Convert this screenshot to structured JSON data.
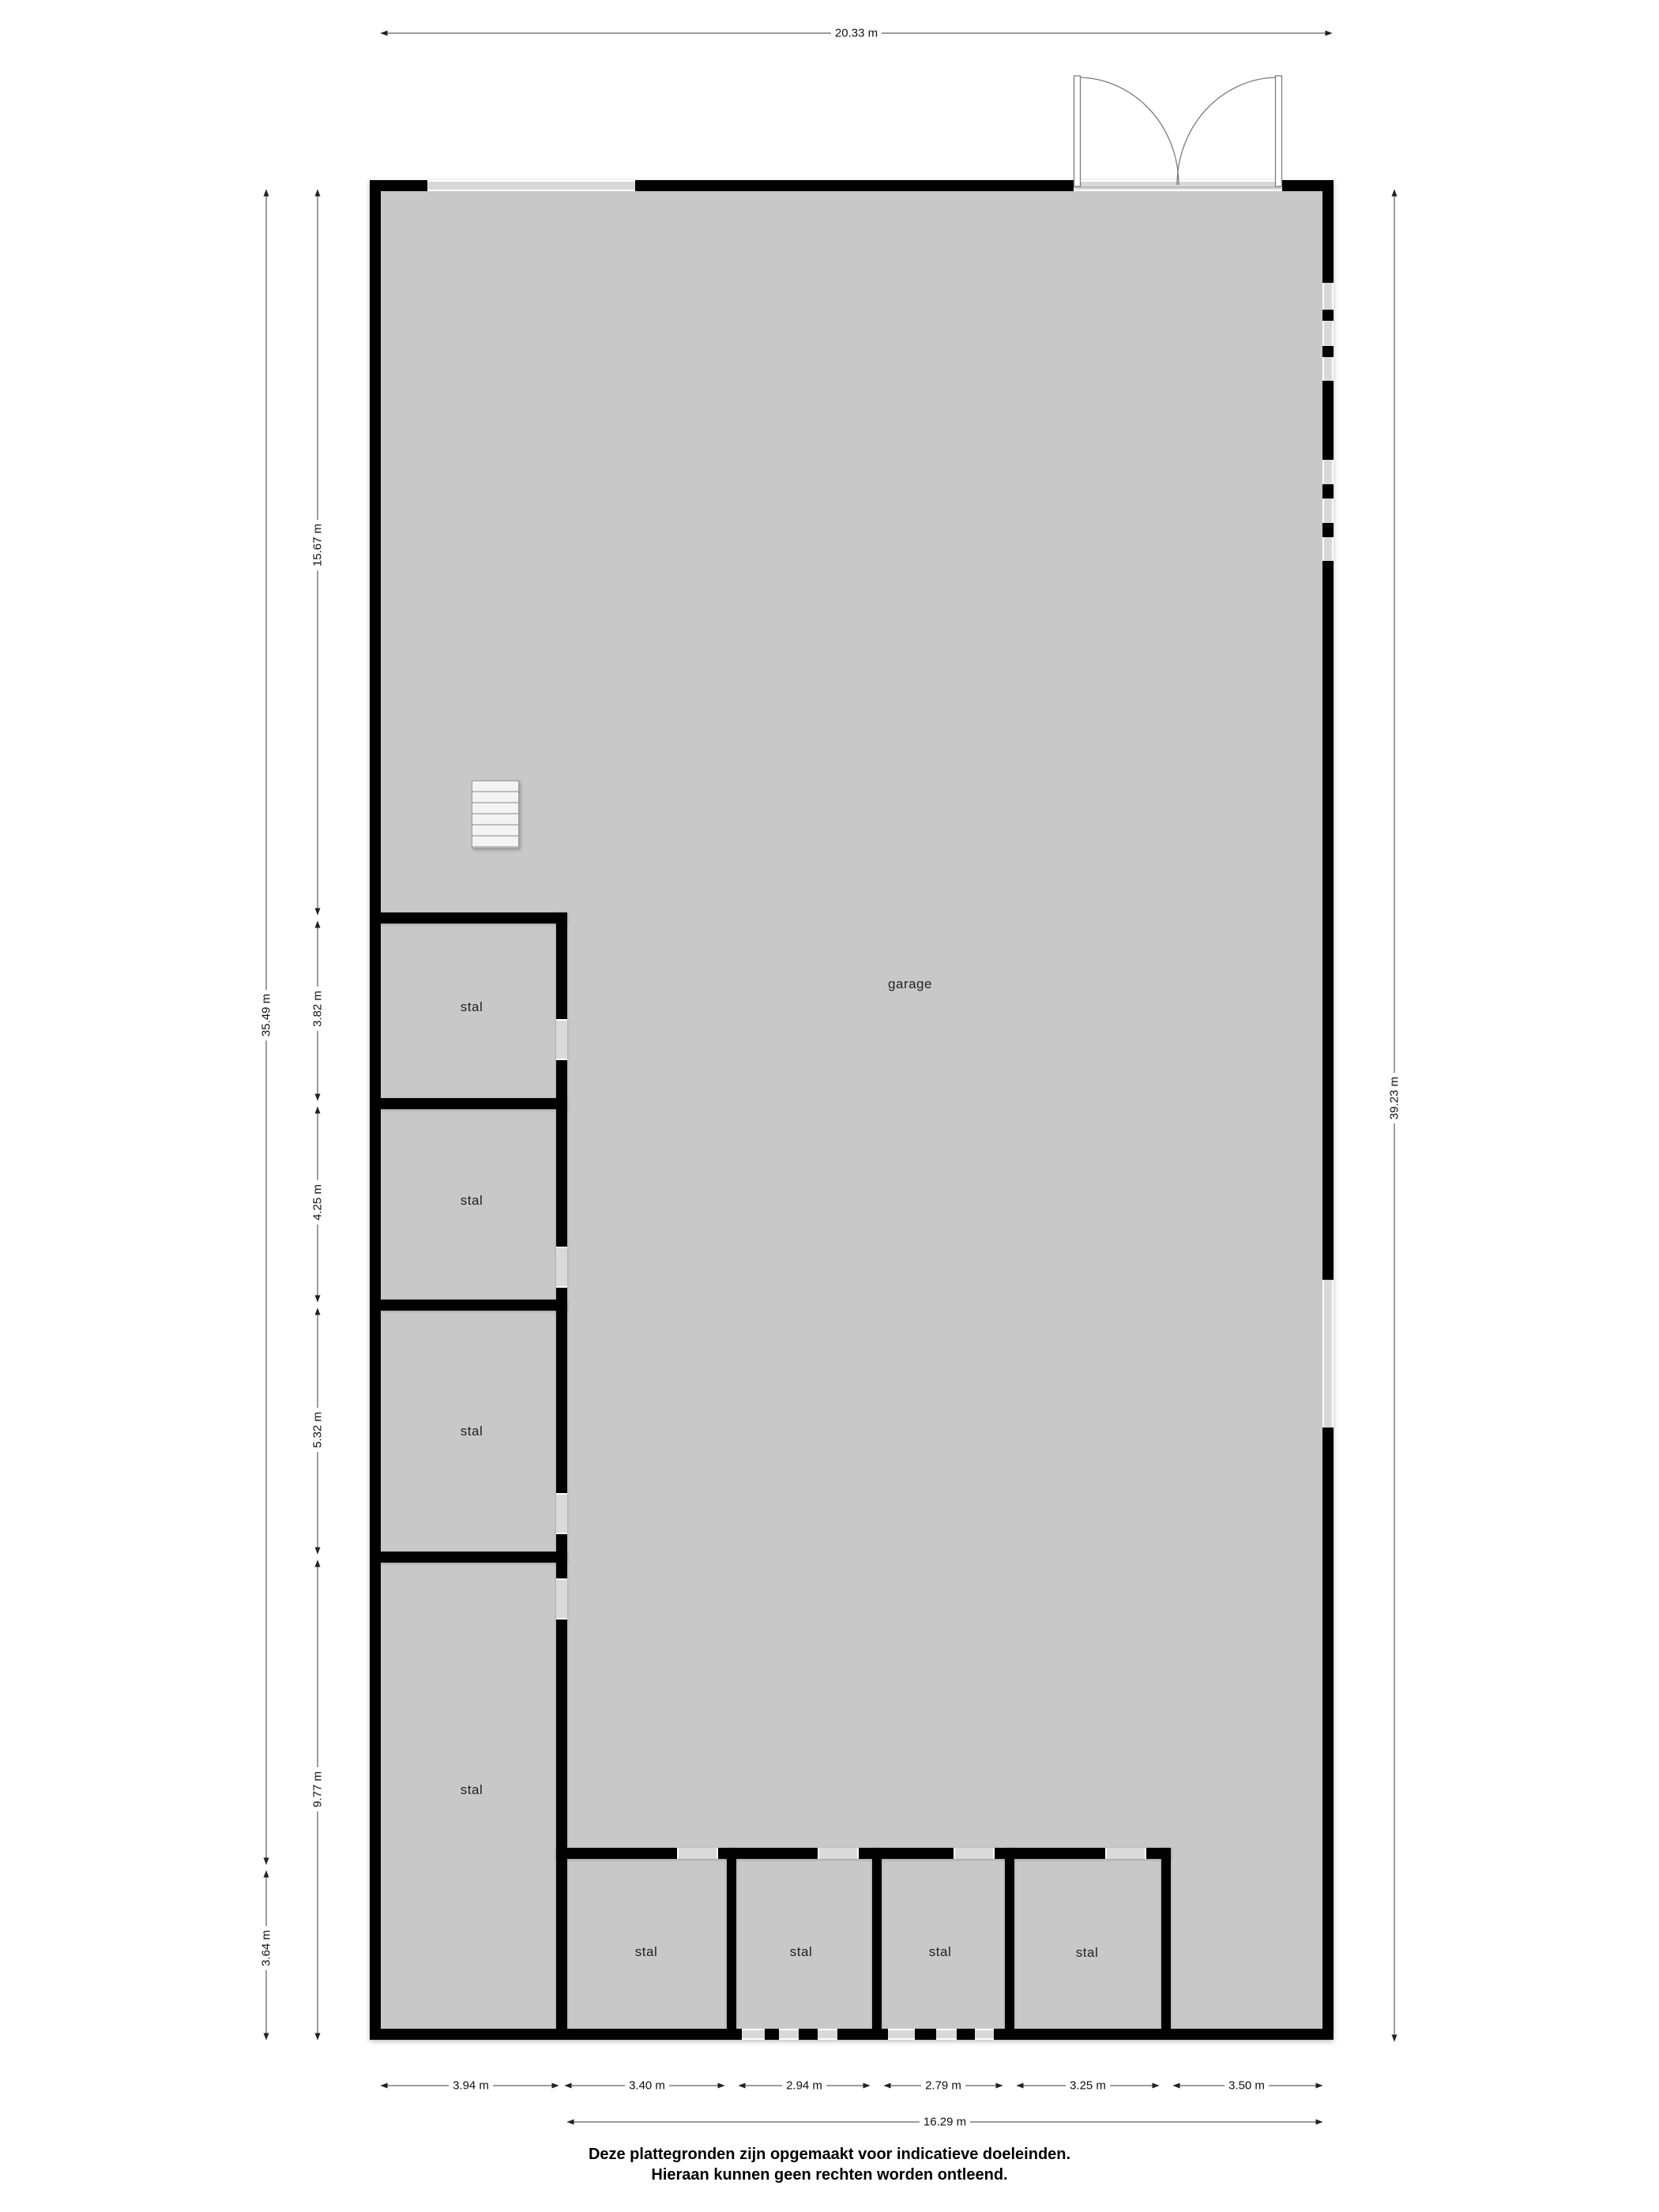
{
  "title": "floor-plan",
  "rooms": {
    "garage": "garage",
    "stals": [
      "stal",
      "stal",
      "stal",
      "stal",
      "stal",
      "stal",
      "stal",
      "stal"
    ]
  },
  "dimensions": {
    "top_width": "20.33 m",
    "right_height": "39.23 m",
    "left_total": "35.49 m",
    "left_bottom": "3.64 m",
    "left_segments": [
      "15.67 m",
      "3.82 m",
      "4.25 m",
      "5.32 m",
      "9.77 m"
    ],
    "bottom_segments": [
      "3.94 m",
      "3.40 m",
      "2.94 m",
      "2.79 m",
      "3.25 m",
      "3.50 m"
    ],
    "bottom_total": "16.29 m"
  },
  "footer": {
    "line1": "Deze plattegronden zijn opgemaakt voor indicatieve doeleinden.",
    "line2": "Hieraan kunnen geen rechten worden ontleend."
  },
  "colors": {
    "background": "#ffffff",
    "floor": "#c8c8c8",
    "wall": "#000000",
    "window": "#d8d8d8",
    "door": "#dadada",
    "dimension_line": "#3a3a3a",
    "text": "#111111"
  }
}
